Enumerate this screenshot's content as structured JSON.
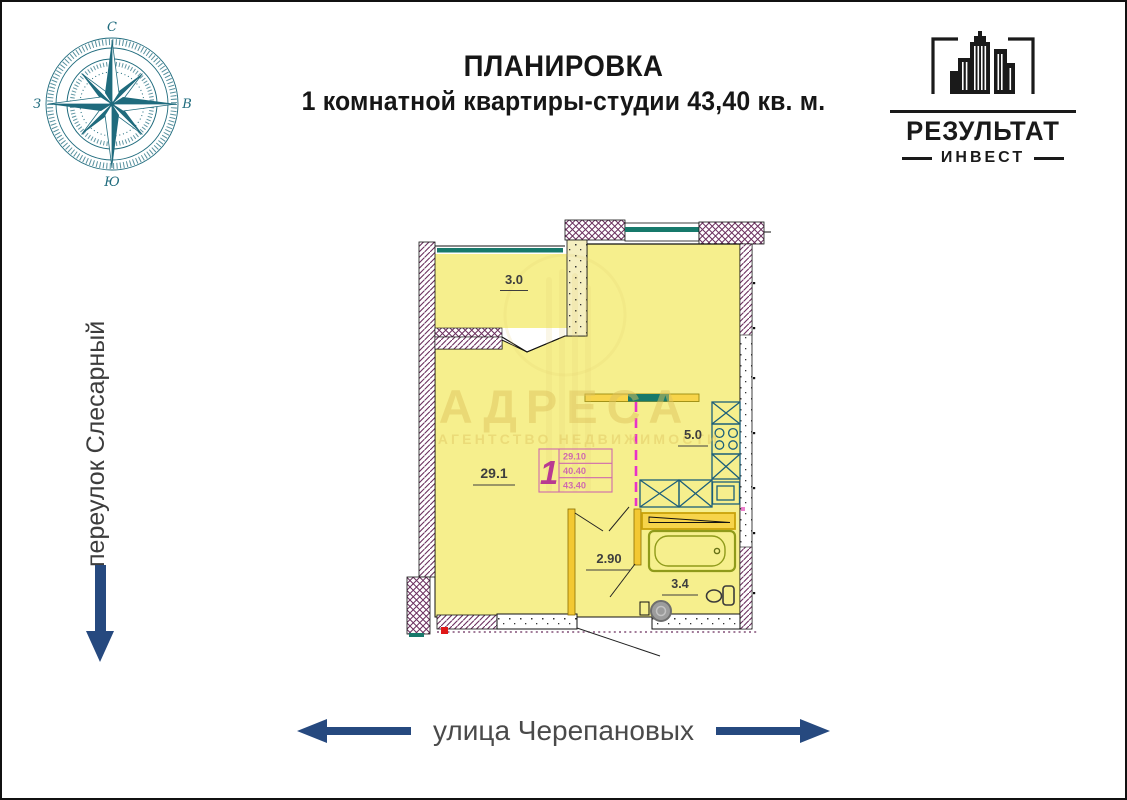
{
  "header": {
    "title_line1": "ПЛАНИРОВКА",
    "title_line2": "1 комнатной квартиры-студии 43,40 кв. м."
  },
  "logo": {
    "name": "РЕЗУЛЬТАТ",
    "subtitle": "ИНВЕСТ"
  },
  "compass": {
    "letters": {
      "top": "С",
      "right": "В",
      "bottom": "Ю",
      "left": "З"
    },
    "color": "#1f6b7d"
  },
  "streets": {
    "left": {
      "label": "переулок Слесарный",
      "arrow_direction": "down"
    },
    "bottom": {
      "label": "улица Черепановых",
      "arrow_directions": "left and right"
    },
    "arrow_color": "#26497f",
    "text_color": "#4a4a4a"
  },
  "plan": {
    "rooms": [
      {
        "name": "balcony",
        "area": "3.0"
      },
      {
        "name": "living-room",
        "area": "29.1"
      },
      {
        "name": "kitchen",
        "area": "5.0"
      },
      {
        "name": "hallway",
        "area": "2.90"
      },
      {
        "name": "bathroom",
        "area": "3.4"
      }
    ],
    "stamp": {
      "rooms": "1",
      "living_area": "29.10",
      "apartment_area": "40.40",
      "total_area": "43.40"
    },
    "colors": {
      "room_fill": "#f6ef8d",
      "wall_hatch": "#6b2f5e",
      "window_teal": "#17796b",
      "kitchen_fixture": "#1d5f7a",
      "partition_yellow": "#f3c832",
      "bath_fixture_olive": "#8f9a1a",
      "divider_dashed_magenta": "#e832c8",
      "stamp_pink": "#cf6aad"
    }
  },
  "watermark": {
    "title": "АДРЕСА",
    "subtitle": "АГЕНТСТВО НЕДВИЖИМОСТИ"
  }
}
